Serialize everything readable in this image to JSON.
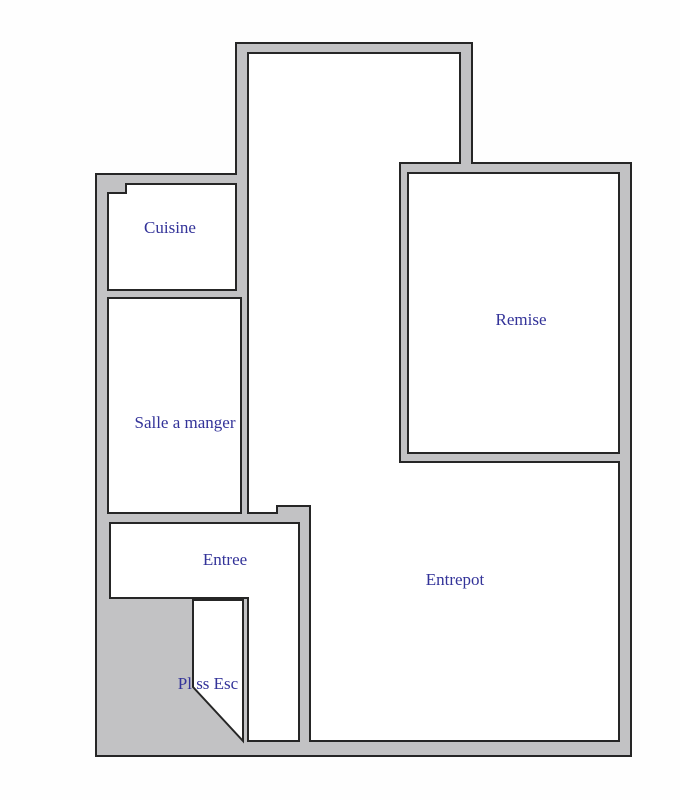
{
  "diagram_title": "",
  "colors": {
    "wall_fill": "#c2c2c4",
    "outline": "#262626",
    "room_fill": "#ffffff",
    "label_color": "#333399",
    "page_bg": "#fefefe"
  },
  "rooms": {
    "cuisine": {
      "label": "Cuisine"
    },
    "salle_a_manger": {
      "label": "Salle a manger"
    },
    "remise": {
      "label": "Remise"
    },
    "entree": {
      "label": "Entree"
    },
    "entrepot": {
      "label": "Entrepot"
    },
    "palier_sous_escalier": {
      "label": "Pl ss Esc"
    }
  }
}
